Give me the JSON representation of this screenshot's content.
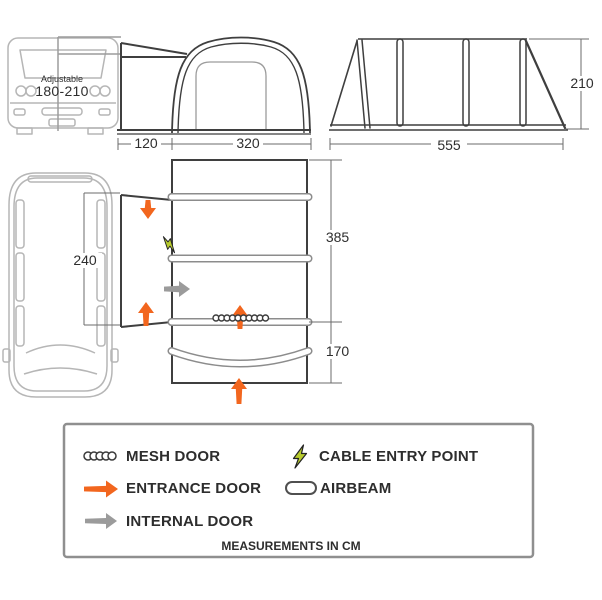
{
  "front_view": {
    "adjustable_label": "Adjustable",
    "adjustable_range": "180-210",
    "tunnel_width": "120",
    "awning_width": "320"
  },
  "side_view": {
    "length": "555",
    "height": "210"
  },
  "plan_view": {
    "attachment_length": "240",
    "main_length": "385",
    "porch_length": "170"
  },
  "legend": {
    "mesh_door": "MESH DOOR",
    "cable_entry_point": "CABLE ENTRY POINT",
    "entrance_door": "ENTRANCE DOOR",
    "airbeam": "AIRBEAM",
    "internal_door": "INTERNAL DOOR",
    "footer": "MEASUREMENTS IN CM"
  },
  "colors": {
    "entrance": "#f2661e",
    "internal": "#9b9b9b",
    "cable": "#b8cc2e",
    "line-dark": "#3f3f3f",
    "line-light": "#b6b6b6"
  }
}
